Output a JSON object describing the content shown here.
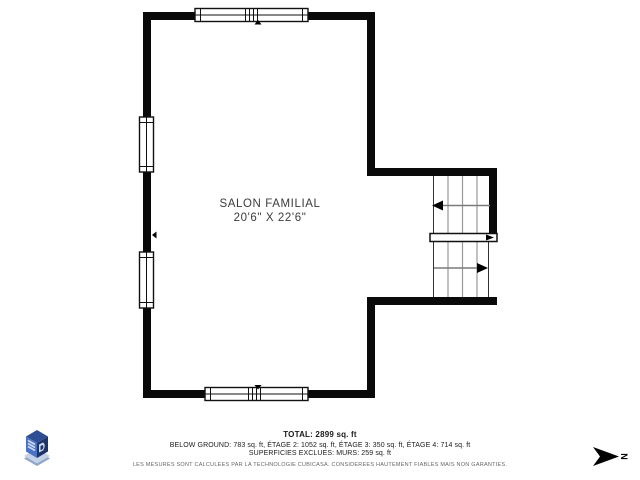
{
  "floorplan": {
    "room": {
      "name": "SALON FAMILIAL",
      "dimensions": "20'6\" X 22'6\""
    },
    "footer": {
      "total": "TOTAL: 2899 sq. ft",
      "breakdown": "BELOW GROUND: 783 sq. ft, ÉTAGE 2: 1052 sq. ft, ÉTAGE 3: 350 sq. ft, ÉTAGE 4: 714 sq. ft",
      "exclusions": "SUPERFICIES EXCLUES: MURS: 259 sq. ft",
      "disclaimer": "LES MESURES SONT CALCULEES PAR LA TECHNOLOGIE CUBICASA. CONSIDEREES HAUTEMENT FIABLES MAIS NON GARANTIES."
    },
    "compass": {
      "label": "N"
    },
    "icons": {
      "logo": "cubicasa-3d-logo",
      "compass": "north-arrow"
    },
    "colors": {
      "wall": "#0a0a0a",
      "stair_tread": "#999999",
      "stair_arrow": "#7a7a7a",
      "room_text": "#3b3b3b",
      "logo_top": "#2e4d92",
      "logo_left": "#4a72c4",
      "logo_right": "#1d3569",
      "logo_base_light": "#c5d1e6",
      "logo_base_dark": "#8fa5c9"
    }
  }
}
